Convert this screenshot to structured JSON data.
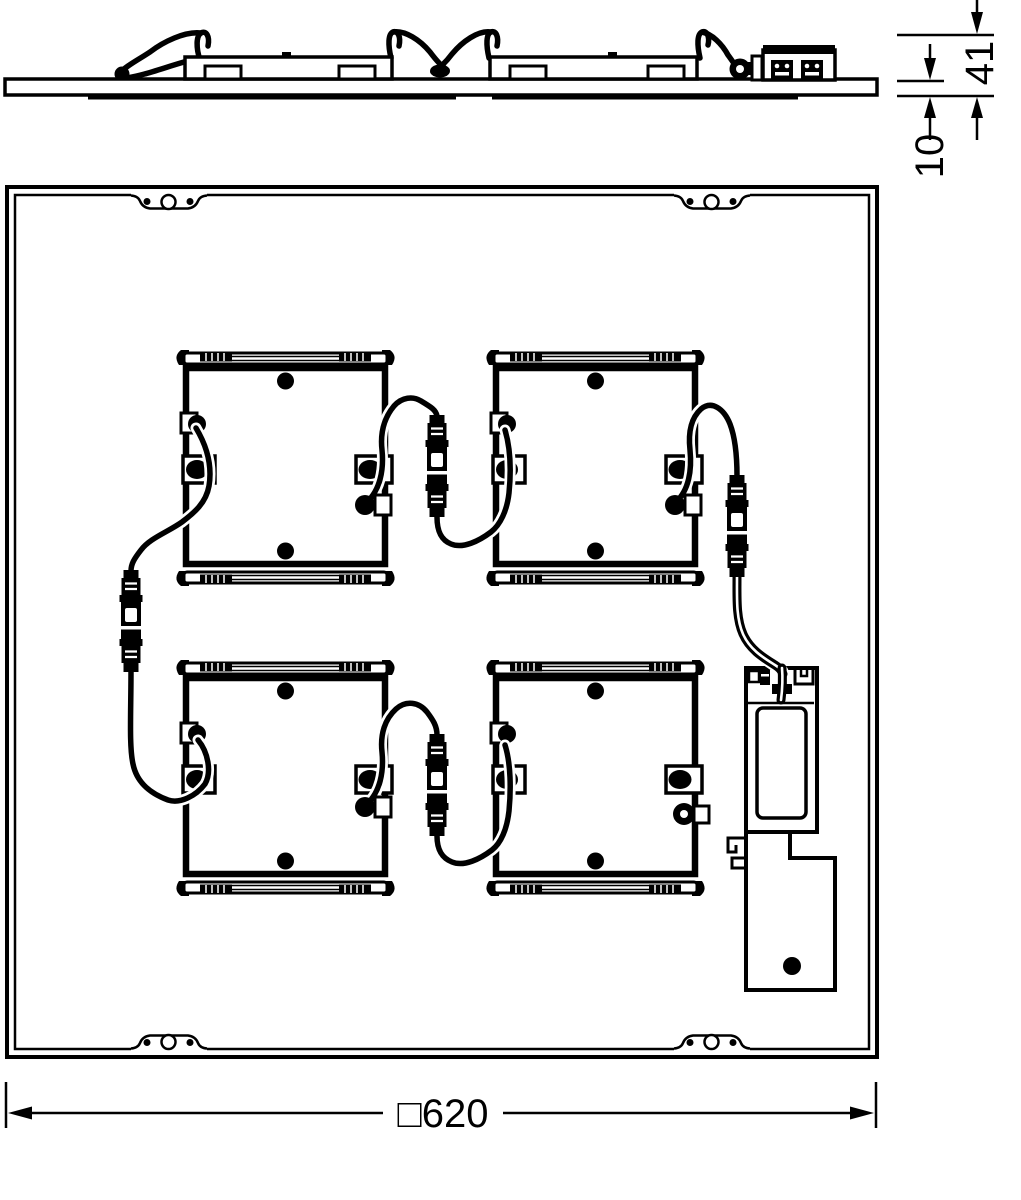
{
  "drawing": {
    "type": "technical-dimension-drawing",
    "views": [
      "side-profile-view",
      "rear-view"
    ],
    "colors": {
      "line": "#000000",
      "background": "#ffffff"
    }
  },
  "dims": {
    "height": "41",
    "thickness": "10",
    "square": "□620"
  }
}
